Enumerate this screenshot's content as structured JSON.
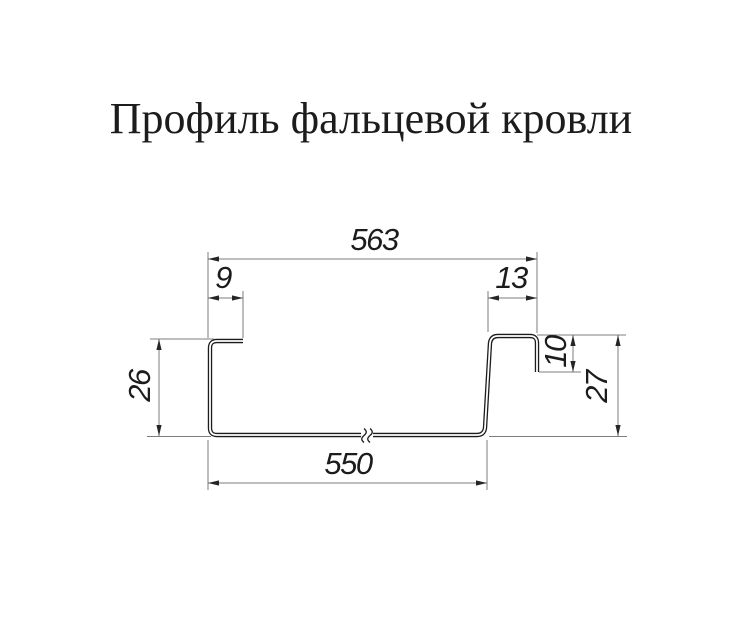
{
  "title": "Профиль фальцевой кровли",
  "dimensions": {
    "overall_width": "563",
    "left_flange_width": "9",
    "right_flange_width": "13",
    "left_height": "26",
    "right_lock_height": "10",
    "right_height": "27",
    "base_width": "550"
  },
  "colors": {
    "background": "#ffffff",
    "profile_line": "#1c1c1c",
    "dimension_line": "#7d7d7d",
    "arrow": "#262626",
    "label_text": "#1c1c1c"
  }
}
